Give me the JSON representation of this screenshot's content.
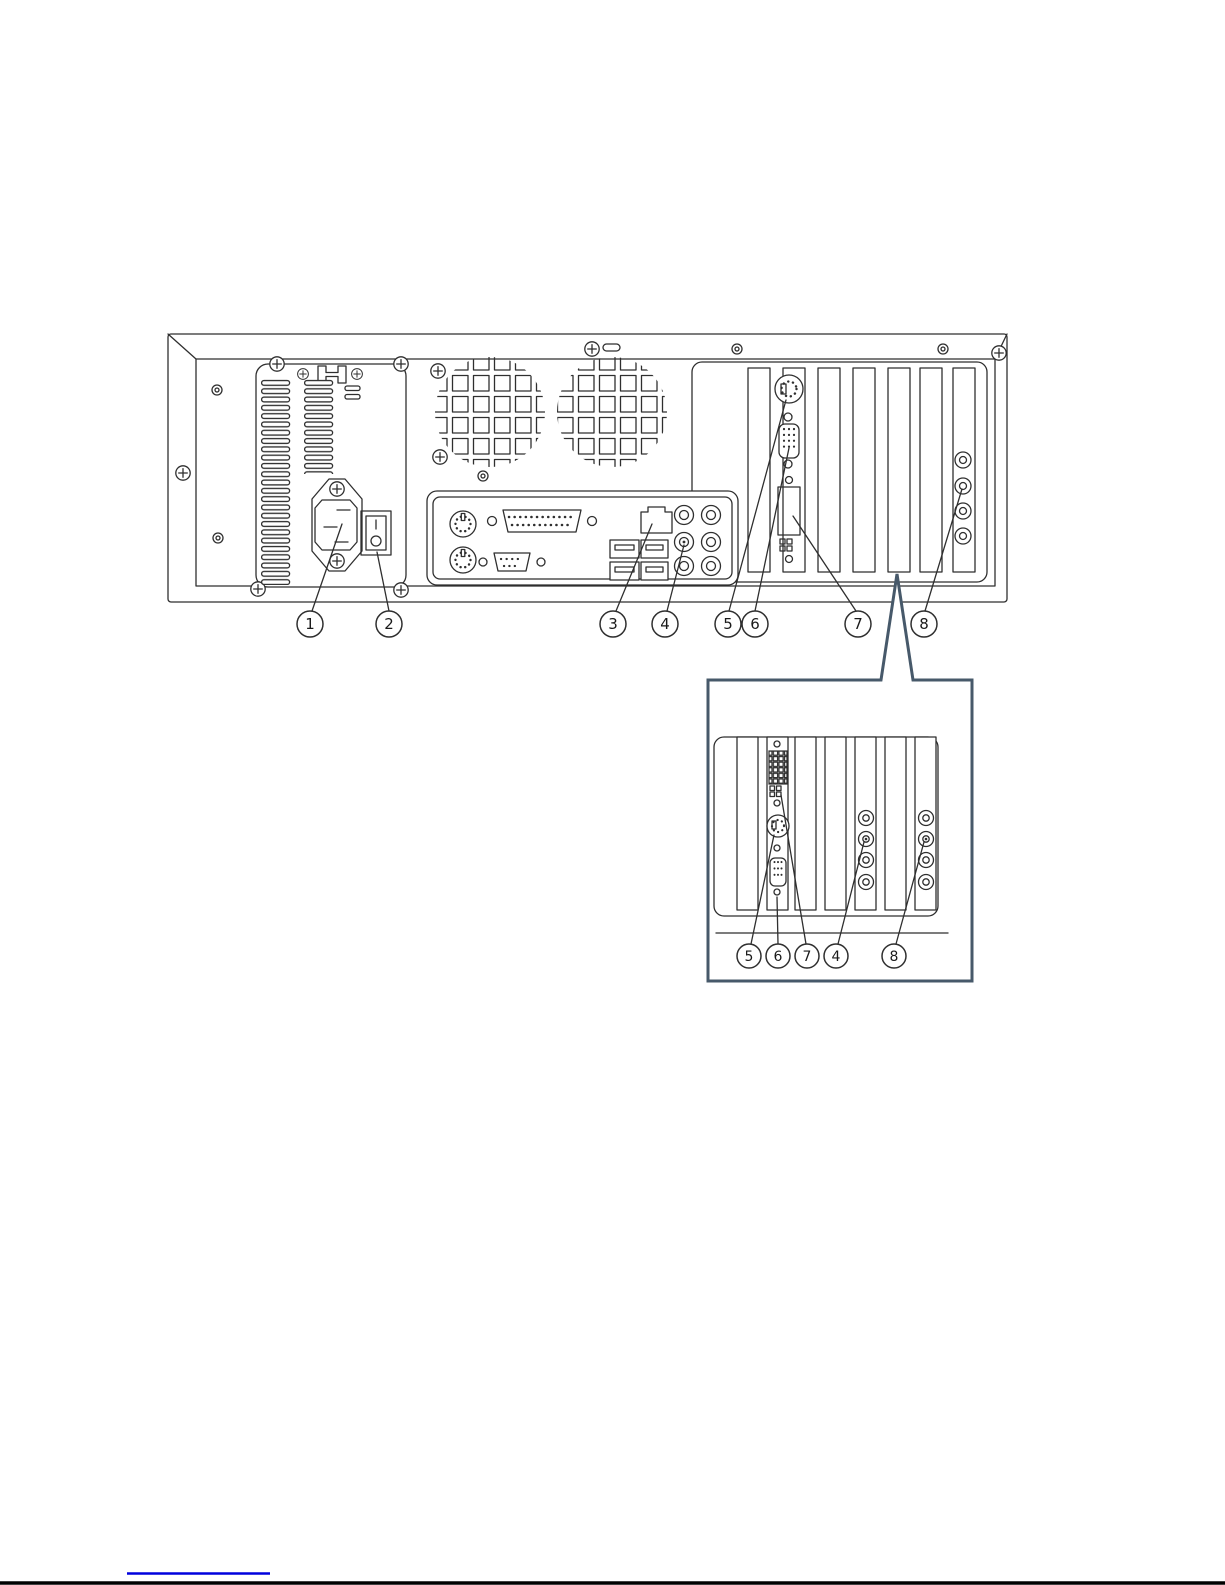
{
  "figure": {
    "callouts_main": [
      "1",
      "2",
      "3",
      "4",
      "5",
      "6",
      "7",
      "8"
    ],
    "callouts_inset": [
      "5",
      "6",
      "7",
      "4",
      "8"
    ]
  },
  "colors": {
    "line": "#2f2f2f",
    "inset_border": "#47596a",
    "link": "#0000dd",
    "page_border": "#000000"
  }
}
